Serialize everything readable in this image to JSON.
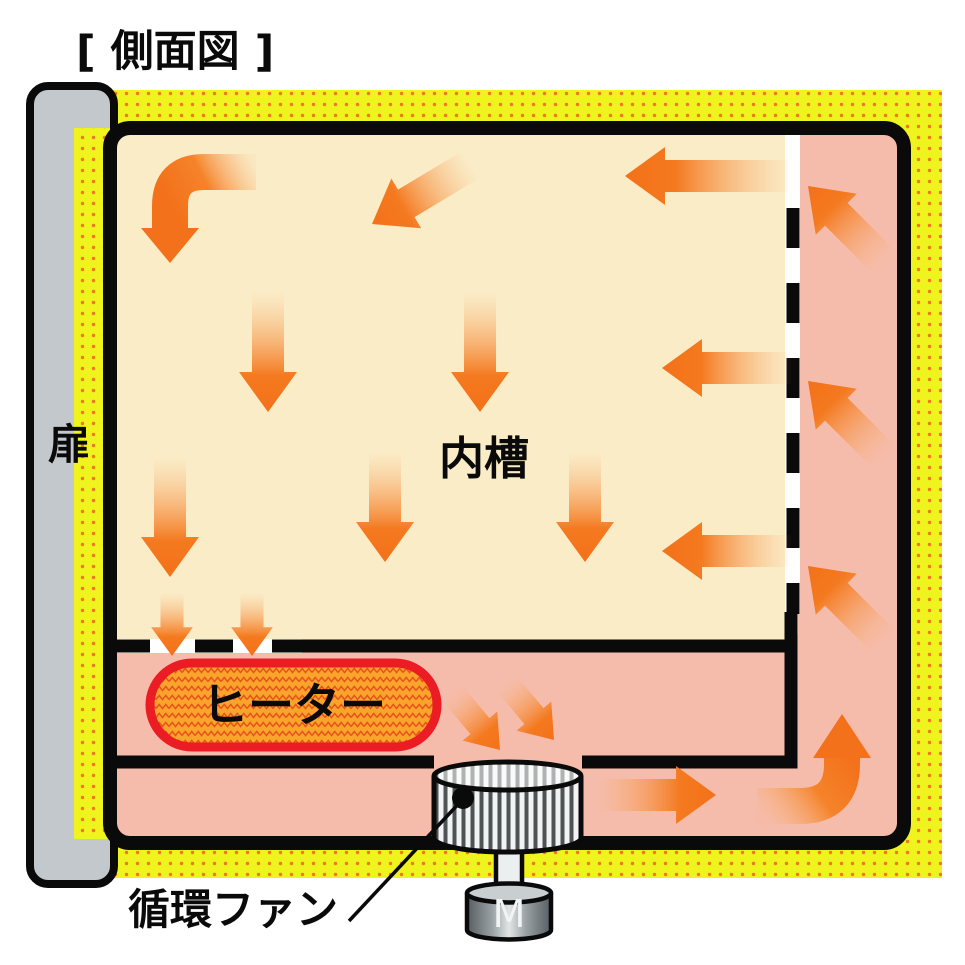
{
  "title": "[ 側面図 ]",
  "labels": {
    "door": "扉",
    "inner_chamber": "内槽",
    "heater": "ヒーター",
    "circulation_fan": "循環ファン",
    "motor": "M"
  },
  "colors": {
    "insulation_yellow": "#EFF31E",
    "insulation_dots": "#F07820",
    "chamber_cream": "#FAECC7",
    "duct_pink": "#F6BCAB",
    "arrow_orange": "#F3711A",
    "heater_fill": "#F9A52B",
    "heater_zigzag": "#E8541E",
    "heater_border": "#EC1C24",
    "door_gray": "#C3C8CC",
    "outline_black": "#0A0A0A"
  },
  "airflow": {
    "description": "循環気流",
    "arrows": [
      {
        "region": "inner-chamber",
        "direction": "curve-left-then-down"
      },
      {
        "region": "inner-chamber",
        "direction": "down-left"
      },
      {
        "region": "inner-chamber",
        "direction": "left"
      },
      {
        "region": "inner-chamber",
        "direction": "down"
      },
      {
        "region": "inner-chamber",
        "direction": "down"
      },
      {
        "region": "inner-chamber",
        "direction": "left"
      },
      {
        "region": "inner-chamber",
        "direction": "down"
      },
      {
        "region": "inner-chamber",
        "direction": "down"
      },
      {
        "region": "inner-chamber",
        "direction": "down"
      },
      {
        "region": "inner-chamber",
        "direction": "left"
      },
      {
        "region": "chamber-floor-outlet",
        "direction": "down"
      },
      {
        "region": "chamber-floor-outlet",
        "direction": "down"
      },
      {
        "region": "heater-plenum",
        "direction": "down-right"
      },
      {
        "region": "heater-plenum",
        "direction": "down-right"
      },
      {
        "region": "bottom-duct",
        "direction": "right"
      },
      {
        "region": "bottom-duct-corner",
        "direction": "curve-right-then-up"
      },
      {
        "region": "right-duct",
        "direction": "up-left"
      },
      {
        "region": "right-duct",
        "direction": "up-left"
      },
      {
        "region": "right-duct",
        "direction": "up-left"
      }
    ]
  }
}
